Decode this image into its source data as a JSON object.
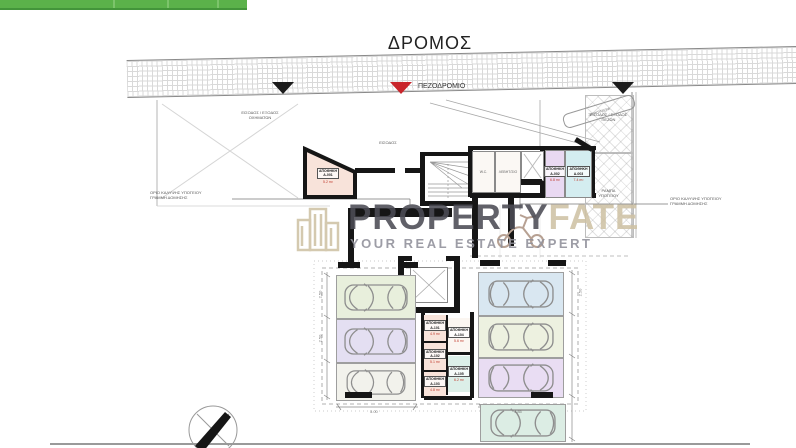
{
  "topbar": {
    "color": "#5bb24a"
  },
  "street": {
    "road_label": "ΔΡΟΜΟΣ",
    "sidewalk_label": "ΠΕΖΟΔΡΟΜΙΟ",
    "marker_black": "#1c1c1c",
    "marker_red": "#c9252b"
  },
  "watermark": {
    "brand_primary": "PROPERTY",
    "brand_secondary": "FATE",
    "tagline": "YOUR REAL ESTATE EXPERT",
    "color_dark": "#4c4c55",
    "color_beige": "#cfc2a4",
    "color_tagline": "#90909a"
  },
  "plan": {
    "entrance_label": "ΕΙΣΟΔΟΣ",
    "vehicle_access_note": "ΕΙΣΟΔΟΣ / ΕΞΟΔΟΣ\nΟΧΗΜΑΤΩΝ",
    "pedestrian_access_note": "ΕΙΣΟΔΟΣ / ΕΞΟΔΟΣ\nΠΕΖΩΝ",
    "ramp_note": "ΡΑΜΠΑ\nΥΠΟΓΕΙΟΥ",
    "planter_label": "ΖΑΡΝΤΙΝΙΕΡΑ",
    "left_boundary_note": "ΟΡΙΟ ΚΑΛΥΨΗΣ ΥΠΟΓΕΙΟΥ\nΓΡΑΜΜΗ ΔΟΜΗΣΗΣ",
    "right_boundary_note": "ΟΡΙΟ ΚΑΛΥΨΗΣ ΥΠΟΓΕΙΟΥ\nΓΡΑΜΜΗ ΔΟΜΗΣΗΣ",
    "elevator_label": "ΑΝΕΛΚΥΣΤΗΡΑΣ",
    "rooms": {
      "a001": {
        "name": "ΑΠΟΘΗΚΗ\nA-001",
        "area": "5.2 m²",
        "fill": "#f8e3da"
      },
      "wc": {
        "name": "W.C."
      },
      "mech": {
        "name": "ΛΕΒΗΤ/ΣΙΟ"
      },
      "shaft": {
        "name": "Φ/Α"
      },
      "a002": {
        "name": "ΑΠΟΘΗΚΗ\nA-002",
        "area": "6.8 m²",
        "fill": "#e9d9f2"
      },
      "a003": {
        "name": "ΑΠΟΘΗΚΗ\nA-003",
        "area": "7.4 m²",
        "fill": "#d4edf0"
      },
      "a101": {
        "name": "ΑΠΟΘΗΚΗ\nA-101",
        "area": "4.9 m²",
        "fill": "#f8e3da"
      },
      "a102": {
        "name": "ΑΠΟΘΗΚΗ\nA-102",
        "area": "5.1 m²",
        "fill": "#f8e3da"
      },
      "a103": {
        "name": "ΑΠΟΘΗΚΗ\nA-103",
        "area": "4.8 m²",
        "fill": "#f8e3da"
      },
      "a104": {
        "name": "ΑΠΟΘΗΚΗ\nA-104",
        "area": "5.6 m²",
        "fill": "#fbf6f1"
      },
      "a105": {
        "name": "ΑΠΟΘΗΚΗ\nA-105",
        "area": "6.2 m²",
        "fill": "#dcefe8"
      }
    },
    "stalls": [
      {
        "color": "#e8efdc"
      },
      {
        "color": "#e4dff2"
      },
      {
        "color": "#f2f2ec"
      },
      {
        "color": "#d9e7f1"
      },
      {
        "color": "#edf1e0"
      },
      {
        "color": "#e9ddf3"
      },
      {
        "color": "#dcede4"
      }
    ],
    "dims": {
      "d1": "2.50",
      "d2": "2.50",
      "d3": "2.50",
      "d4": "5.00",
      "d5": "4.85"
    }
  }
}
